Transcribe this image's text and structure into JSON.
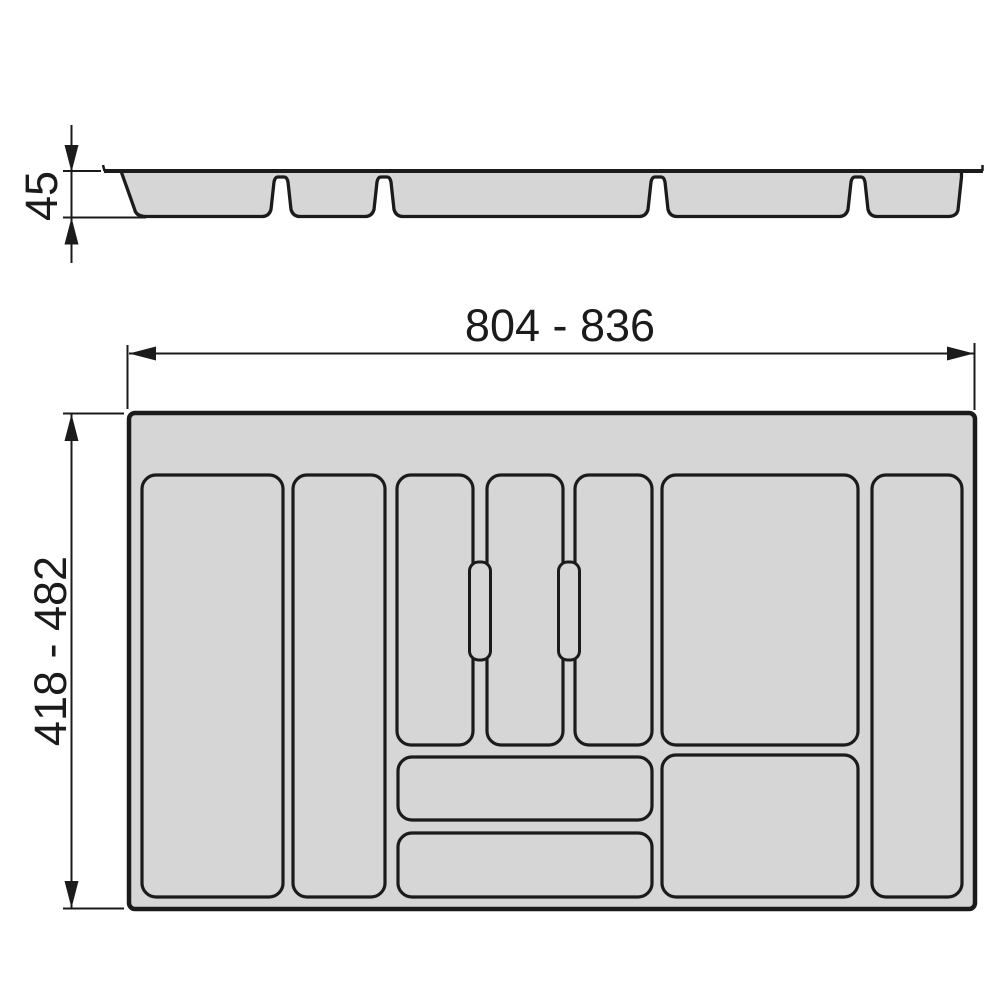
{
  "title": "Cutlery tray technical drawing",
  "colors": {
    "line": "#1b1b1b",
    "fill": "#d6d6d6",
    "bg": "#ffffff"
  },
  "views": {
    "cross_section": {
      "depth_label": "45"
    },
    "top_view": {
      "width_label": "804 - 836",
      "height_label": "418 - 482"
    }
  }
}
